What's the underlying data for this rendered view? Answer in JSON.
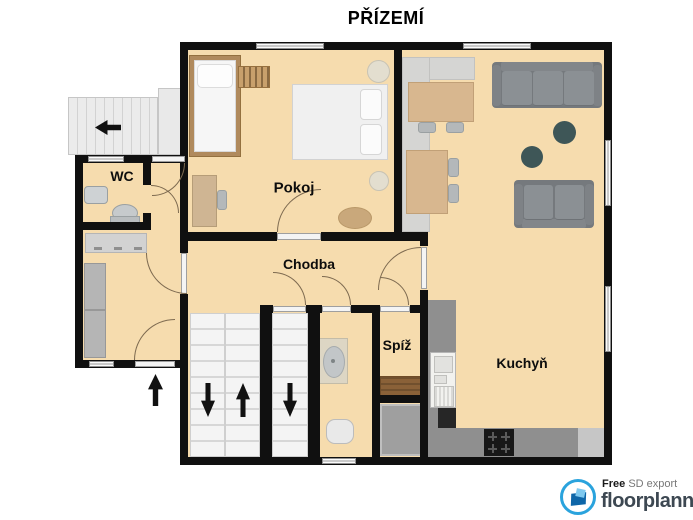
{
  "title": "PŘÍZEMÍ",
  "rooms": {
    "wc": "WC",
    "pokoj": "Pokoj",
    "chodba": "Chodba",
    "spiz": "Spíž",
    "kuchyn": "Kuchyň"
  },
  "logo": {
    "free": "Free",
    "export_label": "SD export",
    "brand": "floorplanner"
  },
  "icons": {
    "main_stairs": [
      "arrow-down-icon",
      "arrow-up-icon"
    ],
    "side_stairs": "arrow-down-icon",
    "exterior_stairs": "arrow-left-icon",
    "entrance": "arrow-up-icon",
    "logo_mark": "floorplanner-logo-icon"
  },
  "colors": {
    "floor": "#f6dcae",
    "wall": "#101010",
    "counter_light": "#d5d5d3",
    "counter_dark": "#8f8f8f",
    "sofa": "#75797d",
    "accent_teal": "#3e5657",
    "wood_shelf": "#8a6138",
    "logo_blue": "#2aa3dd"
  }
}
